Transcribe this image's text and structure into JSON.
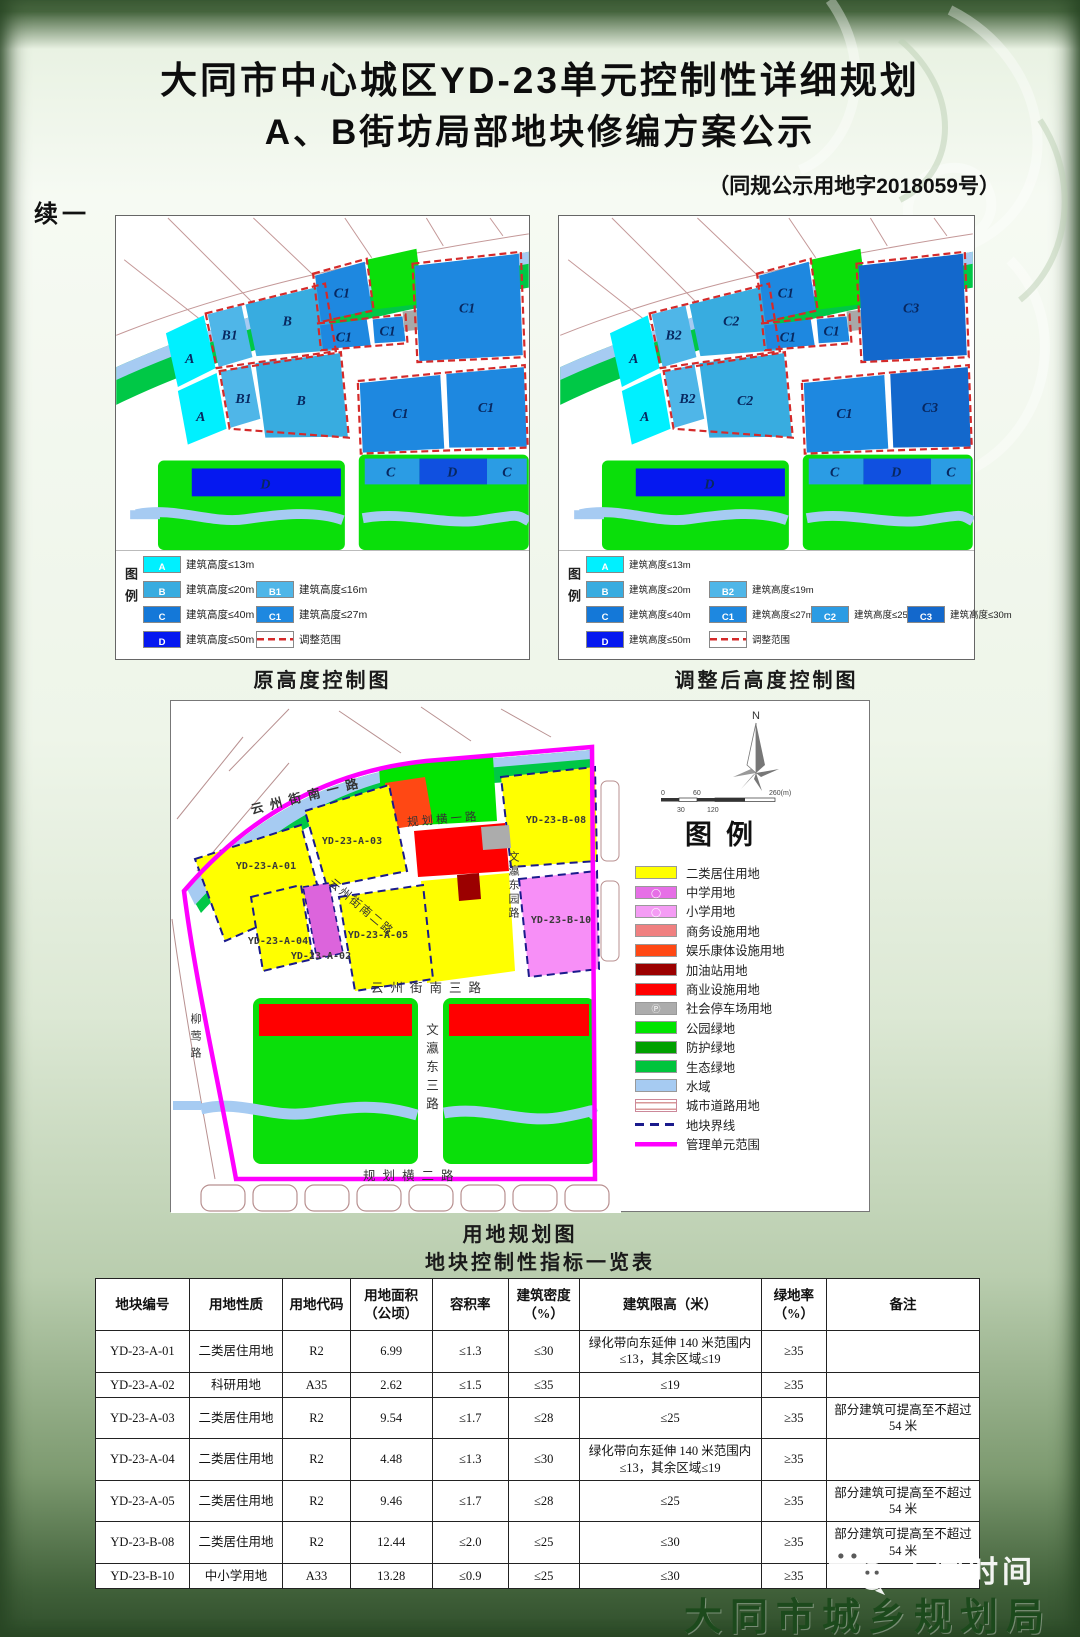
{
  "page": {
    "cont": "续一",
    "title1": "大同市中心城区YD-23单元控制性详细规划",
    "title2": "A、B街坊局部地块修编方案公示",
    "doc_no": "（同规公示用地字2018059号）"
  },
  "maps": {
    "left": {
      "caption": "原高度控制图",
      "legend_title": "图例",
      "parcels": {
        "a1": "A",
        "b1a": "B1",
        "b": "B",
        "a2": "A",
        "b1b": "B1",
        "b2": "B",
        "c_top": "C1",
        "c_m1": "C1",
        "c_m2": "C1",
        "c_r": "C1",
        "c_b1": "C1",
        "c_b2": "C1",
        "d": "D",
        "s1": "C",
        "s2": "D",
        "s3": "C"
      },
      "legend": [
        {
          "code": "A",
          "label": "建筑高度≤13m",
          "color": "#00F0FF"
        },
        {
          "code": "B",
          "label": "建筑高度≤20m",
          "color": "#38ACE0"
        },
        {
          "code": "B1",
          "label": "建筑高度≤16m",
          "color": "#4FB6E8"
        },
        {
          "code": "C",
          "label": "建筑高度≤40m",
          "color": "#1478D8"
        },
        {
          "code": "C1",
          "label": "建筑高度≤27m",
          "color": "#1E88E0"
        },
        {
          "code": "D",
          "label": "建筑高度≤50m",
          "color": "#0518F0"
        },
        {
          "code": "",
          "label": "调整范围",
          "color": "dashed"
        }
      ]
    },
    "right": {
      "caption": "调整后高度控制图",
      "legend_title": "图例",
      "parcels": {
        "a1": "A",
        "b1a": "B2",
        "b": "C2",
        "a2": "A",
        "b1b": "B2",
        "b2": "C2",
        "c_top": "C1",
        "c_m1": "C1",
        "c_m2": "C1",
        "c_r": "C3",
        "c_b1": "C1",
        "c_b2": "C3",
        "d": "D",
        "s1": "C",
        "s2": "D",
        "s3": "C"
      },
      "legend": [
        {
          "code": "A",
          "label": "建筑高度≤13m",
          "color": "#00F0FF"
        },
        {
          "code": "B",
          "label": "建筑高度≤20m",
          "color": "#38ACE0"
        },
        {
          "code": "B2",
          "label": "建筑高度≤19m",
          "color": "#4FB6E8"
        },
        {
          "code": "C",
          "label": "建筑高度≤40m",
          "color": "#1478D8"
        },
        {
          "code": "C1",
          "label": "建筑高度≤27m",
          "color": "#1E88E0"
        },
        {
          "code": "C2",
          "label": "建筑高度≤25m",
          "color": "#2B9CE4"
        },
        {
          "code": "C3",
          "label": "建筑高度≤30m",
          "color": "#1368CC"
        },
        {
          "code": "D",
          "label": "建筑高度≤50m",
          "color": "#0518F0"
        },
        {
          "code": "",
          "label": "调整范围",
          "color": "dashed"
        }
      ]
    }
  },
  "landuse": {
    "caption": "用地规划图",
    "legend_title": "图例",
    "north": "N",
    "scale": {
      "top": [
        "0",
        "60",
        "260(m)"
      ],
      "bottom": [
        "30",
        "120"
      ]
    },
    "roads": {
      "top": "云州街南一路",
      "mid_h1": "规划横一路",
      "diag": "云州街南二路",
      "south": "云州街南三路",
      "center_v": "文瀛东三路",
      "bottom": "规划横二路",
      "left_v": "柳莺路",
      "right_v": "文瀛东园路"
    },
    "parcels": {
      "a01": "YD-23-A-01",
      "a02": "YD-23-A-02",
      "a03": "YD-23-A-03",
      "a04": "YD-23-A-04",
      "a05": "YD-23-A-05",
      "b08": "YD-23-B-08",
      "b10": "YD-23-B-10"
    },
    "legend": [
      {
        "label": "二类居住用地",
        "color": "#FFFF00"
      },
      {
        "label": "中学用地",
        "color": "#E66FE6",
        "glyph": "◯"
      },
      {
        "label": "小学用地",
        "color": "#F49CF4",
        "glyph": "◯"
      },
      {
        "label": "商务设施用地",
        "color": "#F08080"
      },
      {
        "label": "娱乐康体设施用地",
        "color": "#FF4814"
      },
      {
        "label": "加油站用地",
        "color": "#9B0000"
      },
      {
        "label": "商业设施用地",
        "color": "#FF0000"
      },
      {
        "label": "社会停车场用地",
        "color": "#ACACAC",
        "glyph": "Ⓟ"
      },
      {
        "label": "公园绿地",
        "color": "#00E400"
      },
      {
        "label": "防护绿地",
        "color": "#00A000"
      },
      {
        "label": "生态绿地",
        "color": "#00C43C"
      },
      {
        "label": "水域",
        "color": "#A6CBF2"
      },
      {
        "label": "城市道路用地",
        "color": "#FFFFFF",
        "type": "road"
      },
      {
        "label": "地块界线",
        "color": "#1A1A8C",
        "type": "dashed"
      },
      {
        "label": "管理单元范围",
        "color": "#FF00FF",
        "type": "line"
      }
    ]
  },
  "table": {
    "caption": "地块控制性指标一览表",
    "headers": [
      "地块编号",
      "用地性质",
      "用地代码",
      "用地面积\n（公顷）",
      "容积率",
      "建筑密度\n（%）",
      "建筑限高（米）",
      "绿地率\n（%）",
      "备注"
    ],
    "rows": [
      [
        "YD-23-A-01",
        "二类居住用地",
        "R2",
        "6.99",
        "≤1.3",
        "≤30",
        "绿化带向东延伸 140 米范围内≤13，其余区域≤19",
        "≥35",
        ""
      ],
      [
        "YD-23-A-02",
        "科研用地",
        "A35",
        "2.62",
        "≤1.5",
        "≤35",
        "≤19",
        "≥35",
        ""
      ],
      [
        "YD-23-A-03",
        "二类居住用地",
        "R2",
        "9.54",
        "≤1.7",
        "≤28",
        "≤25",
        "≥35",
        "部分建筑可提高至不超过 54 米"
      ],
      [
        "YD-23-A-04",
        "二类居住用地",
        "R2",
        "4.48",
        "≤1.3",
        "≤30",
        "绿化带向东延伸 140 米范围内≤13，其余区域≤19",
        "≥35",
        ""
      ],
      [
        "YD-23-A-05",
        "二类居住用地",
        "R2",
        "9.46",
        "≤1.7",
        "≤28",
        "≤25",
        "≥35",
        "部分建筑可提高至不超过 54 米"
      ],
      [
        "YD-23-B-08",
        "二类居住用地",
        "R2",
        "12.44",
        "≤2.0",
        "≤25",
        "≤30",
        "≥35",
        "部分建筑可提高至不超过 54 米"
      ],
      [
        "YD-23-B-10",
        "中小学用地",
        "A33",
        "13.28",
        "≤0.9",
        "≤25",
        "≤30",
        "≥35",
        ""
      ]
    ]
  },
  "footer": {
    "watermark": "大同时间",
    "agency": "大同市城乡规划局"
  }
}
